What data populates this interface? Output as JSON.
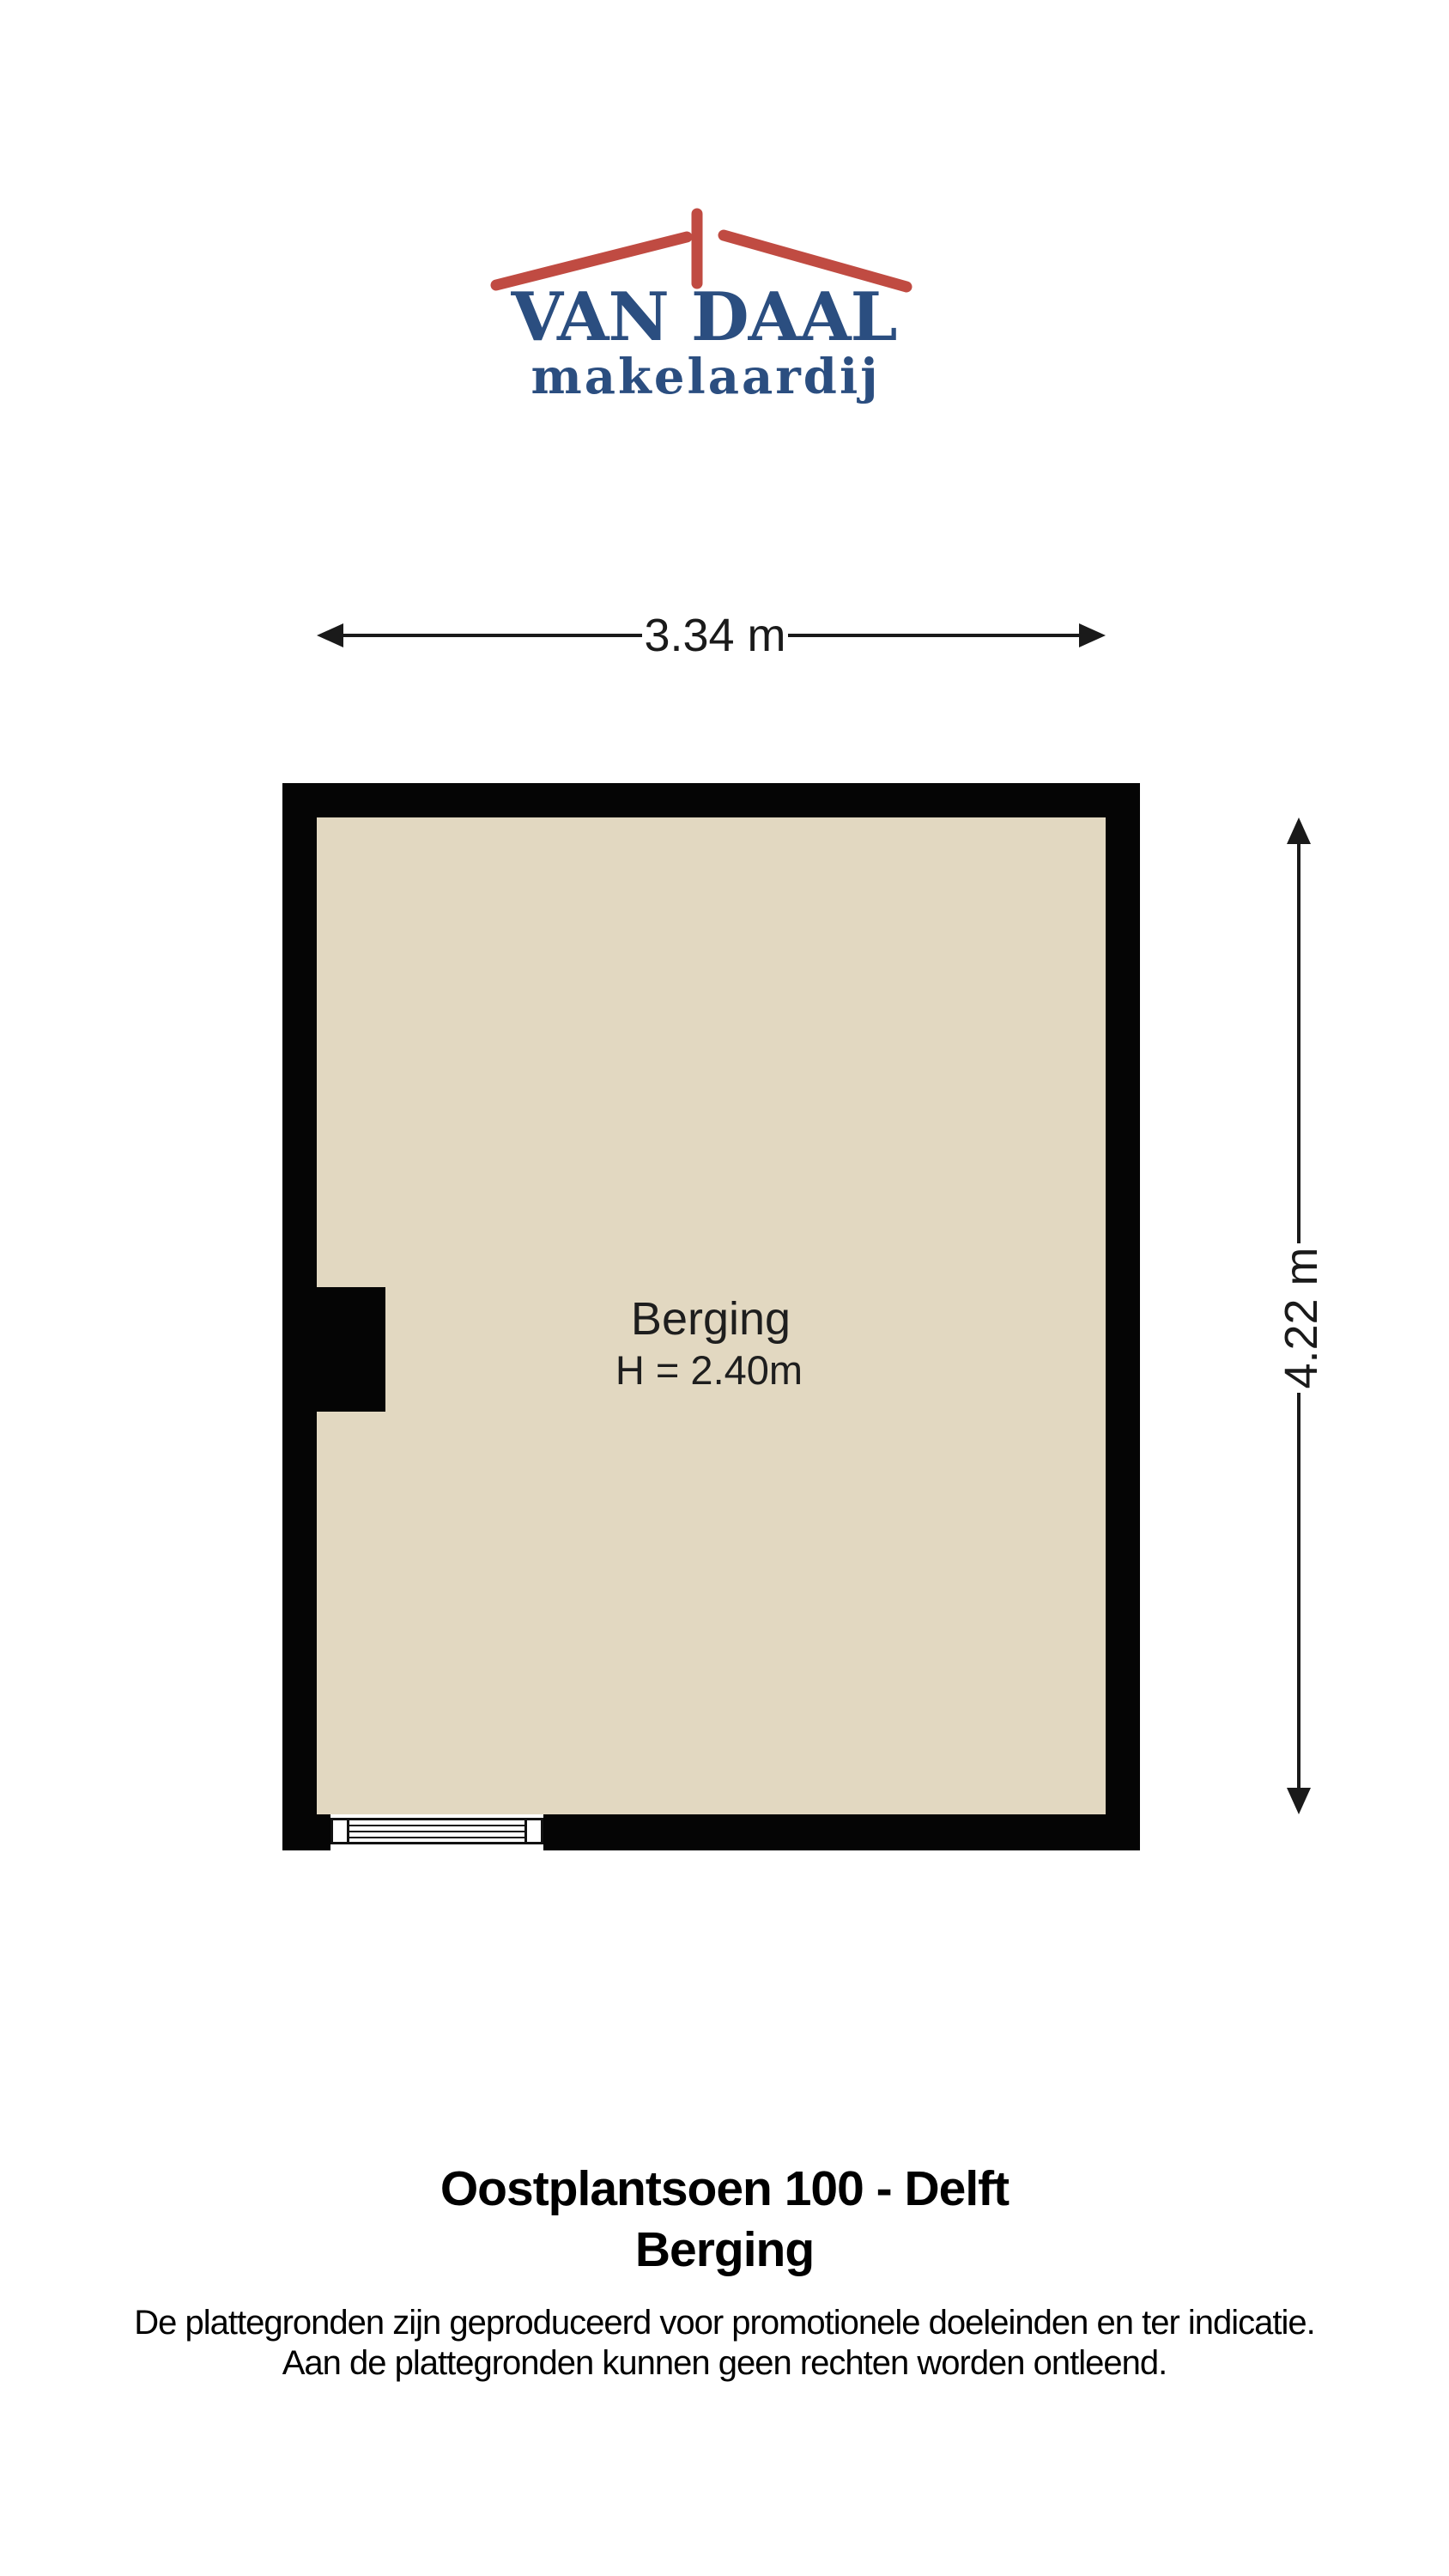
{
  "logo": {
    "title": "VAN DAAL",
    "subtitle": "makelaardij",
    "roof_color": "#C04B42",
    "text_color": "#2B4E80"
  },
  "floorplan": {
    "room_label": "Berging",
    "room_height_label": "H = 2.40m",
    "width_dim_label": "3.34 m",
    "height_dim_label": "4.22 m",
    "floor_color": "#E2D8C1",
    "wall_color": "#050505"
  },
  "footer": {
    "title": "Oostplantsoen 100 - Delft",
    "subtitle": "Berging",
    "disclaimer_line1": "De plattegronden zijn geproduceerd voor promotionele doeleinden en ter indicatie.",
    "disclaimer_line2": "Aan de plattegronden kunnen geen rechten worden ontleend."
  }
}
